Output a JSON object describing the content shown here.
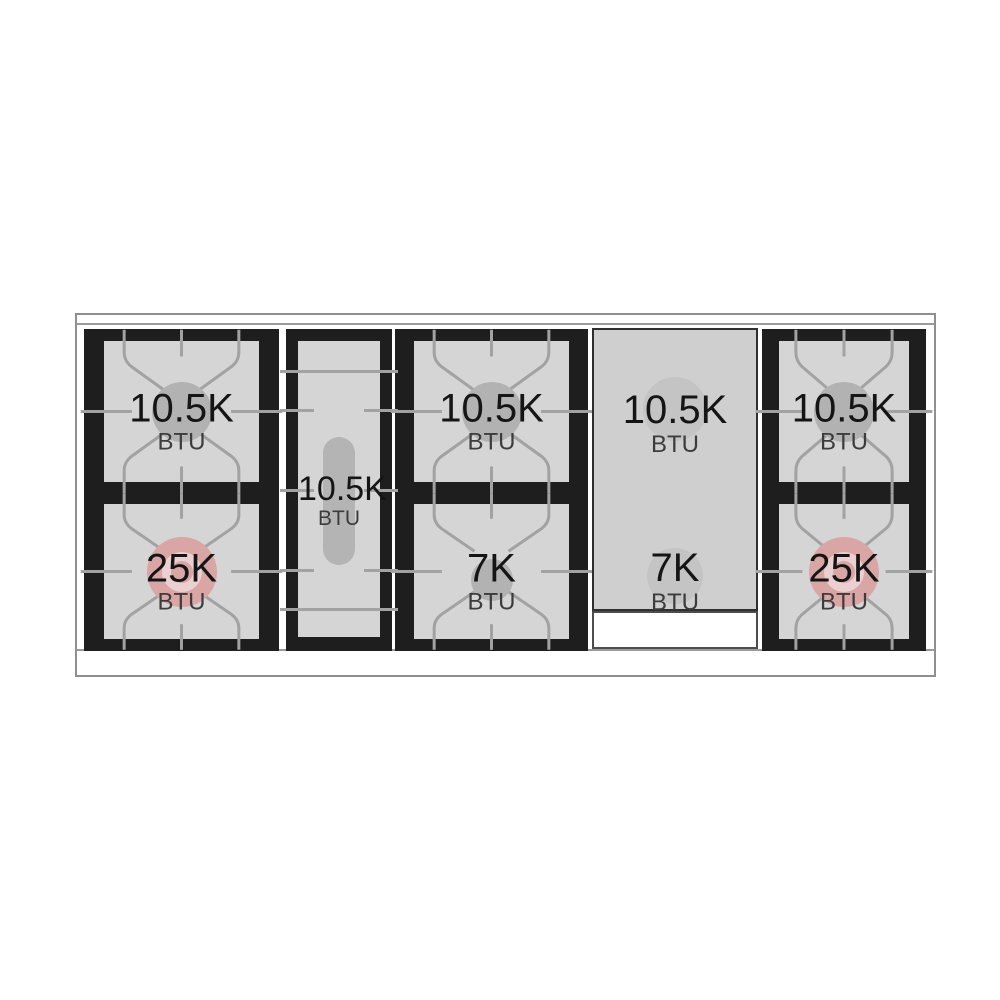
{
  "cooktop": {
    "description": "Gas range cooktop burner layout diagram with BTU ratings",
    "modules": [
      {
        "name": "left-burner-pair",
        "cells": [
          {
            "value": "10.5K",
            "unit": "BTU",
            "burner": "standard"
          },
          {
            "value": "25K",
            "unit": "BTU",
            "burner": "power"
          }
        ]
      },
      {
        "name": "center-oval-burner",
        "cells": [
          {
            "value": "10.5K",
            "unit": "BTU",
            "burner": "oval"
          }
        ]
      },
      {
        "name": "middle-burner-pair",
        "cells": [
          {
            "value": "10.5K",
            "unit": "BTU",
            "burner": "standard"
          },
          {
            "value": "7K",
            "unit": "BTU",
            "burner": "simmer"
          }
        ]
      },
      {
        "name": "griddle-panel",
        "cells": [
          {
            "value": "10.5K",
            "unit": "BTU",
            "burner": "under-griddle"
          },
          {
            "value": "7K",
            "unit": "BTU",
            "burner": "under-griddle"
          }
        ]
      },
      {
        "name": "right-burner-pair",
        "cells": [
          {
            "value": "10.5K",
            "unit": "BTU",
            "burner": "standard"
          },
          {
            "value": "25K",
            "unit": "BTU",
            "burner": "power"
          }
        ]
      }
    ],
    "colors": {
      "module_black": "#1e1e1e",
      "grate_line": "#a2a2a2",
      "cell_gray": "#d5d5d5",
      "burner_gray": "#b2b2b2",
      "power_burner_pink": "#d9a5a5",
      "griddle_panel_gray": "#cfcfcf",
      "frame_gray": "#8f8f8f"
    }
  }
}
